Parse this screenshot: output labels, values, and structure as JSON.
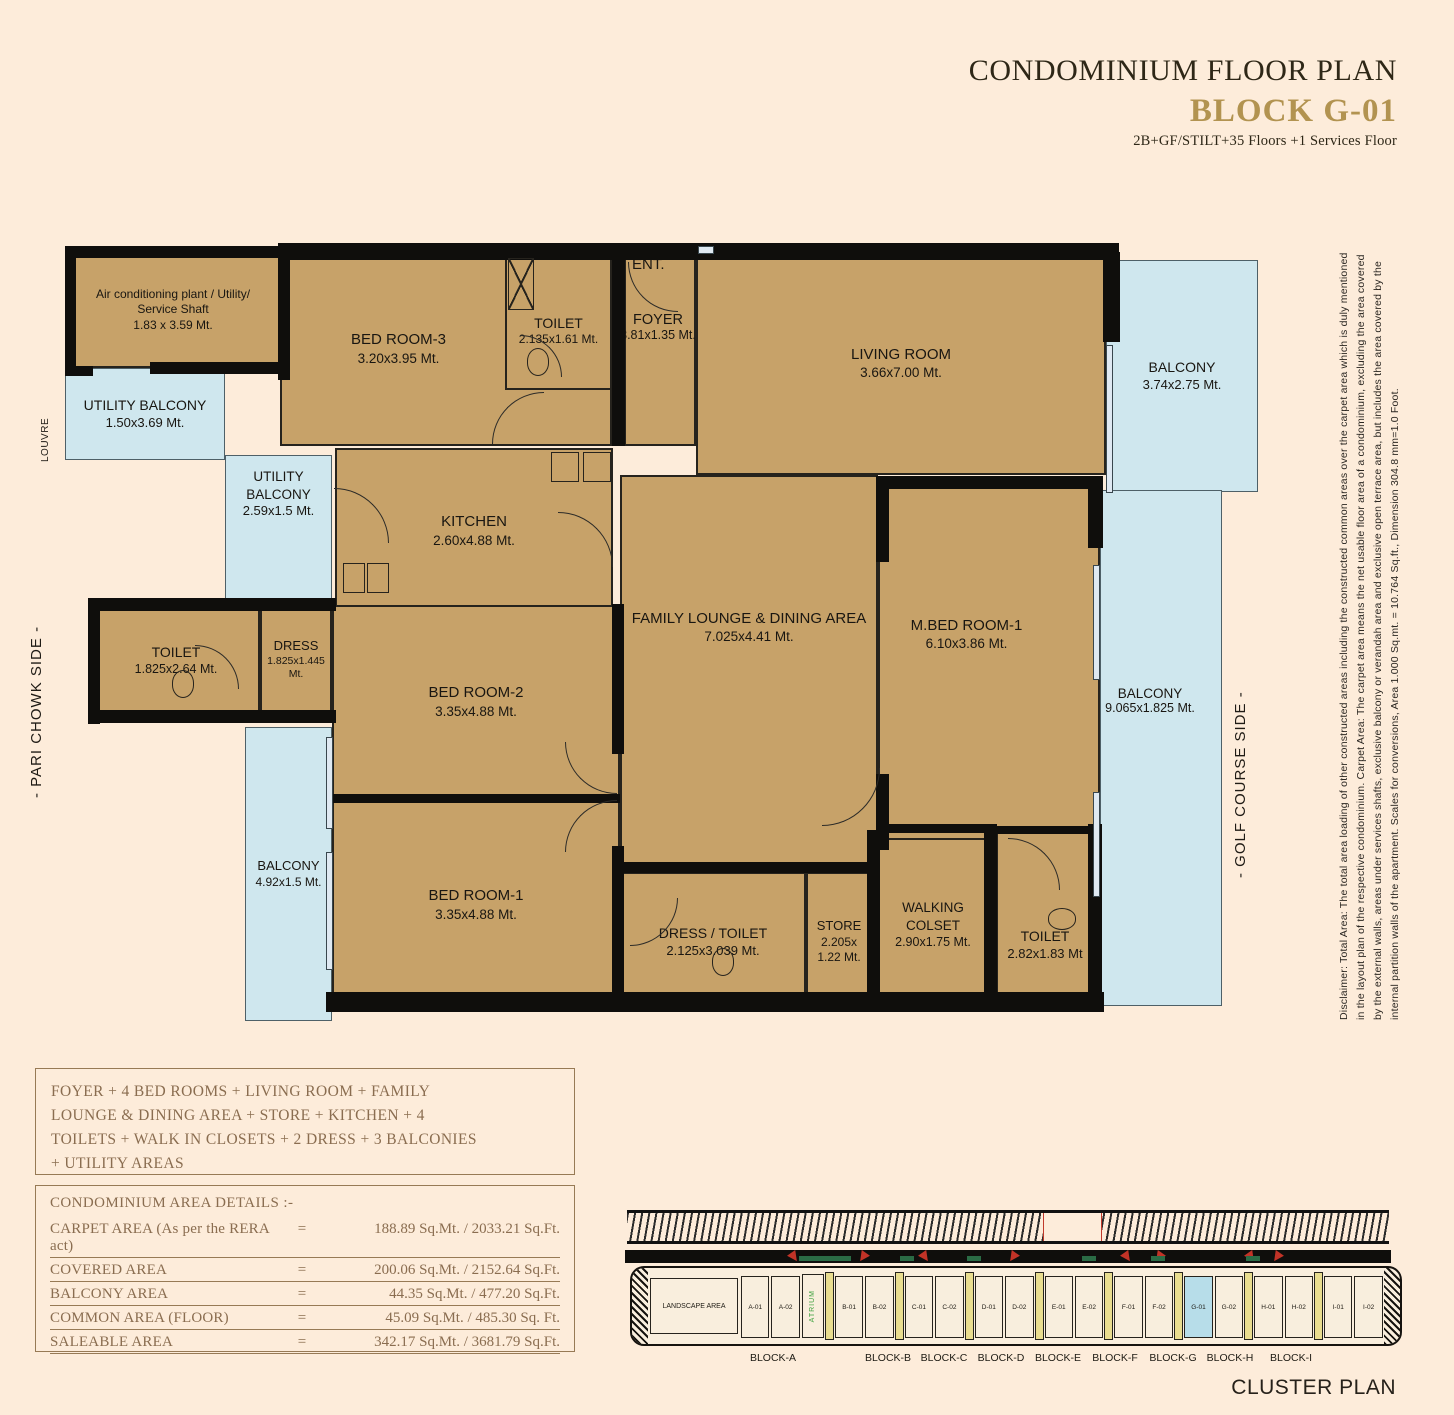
{
  "header": {
    "title": "CONDOMINIUM FLOOR PLAN",
    "block": "BLOCK G-01",
    "subtitle": "2B+GF/STILT+35 Floors +1 Services Floor"
  },
  "side_labels": {
    "left": "- PARI CHOWK SIDE -",
    "right": "- GOLF COURSE SIDE -",
    "louvre": "LOUVRE",
    "ent": "ENT."
  },
  "rooms": [
    {
      "name": "Air conditioning plant / Utility/ Service Shaft",
      "dims": "1.83 x 3.59 Mt."
    },
    {
      "name": "UTILITY BALCONY",
      "dims": "1.50x3.69 Mt."
    },
    {
      "name": "UTILITY BALCONY",
      "dims": "2.59x1.5 Mt."
    },
    {
      "name": "BED ROOM-3",
      "dims": "3.20x3.95 Mt."
    },
    {
      "name": "TOILET",
      "dims": "2.135x1.61 Mt."
    },
    {
      "name": "FOYER",
      "dims": "3.81x1.35 Mt."
    },
    {
      "name": "LIVING ROOM",
      "dims": "3.66x7.00 Mt."
    },
    {
      "name": "BALCONY",
      "dims": "3.74x2.75 Mt."
    },
    {
      "name": "KITCHEN",
      "dims": "2.60x4.88 Mt."
    },
    {
      "name": "FAMILY LOUNGE & DINING AREA",
      "dims": "7.025x4.41 Mt."
    },
    {
      "name": "M.BED ROOM-1",
      "dims": "6.10x3.86 Mt."
    },
    {
      "name": "BALCONY",
      "dims": "9.065x1.825 Mt."
    },
    {
      "name": "TOILET",
      "dims": "1.825x2.64 Mt."
    },
    {
      "name": "DRESS",
      "dims": "1.825x1.445 Mt."
    },
    {
      "name": "BED ROOM-2",
      "dims": "3.35x4.88 Mt."
    },
    {
      "name": "BALCONY",
      "dims": "4.92x1.5 Mt."
    },
    {
      "name": "BED ROOM-1",
      "dims": "3.35x4.88 Mt."
    },
    {
      "name": "DRESS / TOILET",
      "dims": "2.125x3.039 Mt."
    },
    {
      "name": "STORE",
      "dims": "2.205x 1.22 Mt."
    },
    {
      "name": "WALKING COLSET",
      "dims": "2.90x1.75 Mt."
    },
    {
      "name": "TOILET",
      "dims": "2.82x1.83 Mt"
    }
  ],
  "summary_lines": [
    "FOYER + 4 BED ROOMS + LIVING ROOM + FAMILY",
    "LOUNGE & DINING AREA + STORE + KITCHEN + 4",
    "TOILETS + WALK IN CLOSETS + 2 DRESS + 3 BALCONIES",
    "+ UTILITY AREAS"
  ],
  "area_details": {
    "title": "CONDOMINIUM AREA DETAILS :-",
    "eq": "=",
    "rows": [
      {
        "label": "CARPET AREA  (As per the RERA act)",
        "value": "188.89 Sq.Mt. / 2033.21 Sq.Ft."
      },
      {
        "label": "COVERED AREA",
        "value": "200.06 Sq.Mt. / 2152.64 Sq.Ft."
      },
      {
        "label": "BALCONY AREA",
        "value": "44.35 Sq.Mt. / 477.20 Sq.Ft."
      },
      {
        "label": "COMMON AREA (FLOOR)",
        "value": "45.09 Sq.Mt. / 485.30 Sq. Ft."
      },
      {
        "label": "SALEABLE AREA",
        "value": "342.17 Sq.Mt. / 3681.79 Sq.Ft."
      }
    ]
  },
  "disclaimer_lines": [
    "Disclaimer:  Total Area: The total area loading of other constructed areas including the constructed common areas over the carpet area which is duly mentioned",
    "in the layout plan of the respective condominium. Carpet Area: The carpet area means the net usable floor area of a condominium, excluding the area covered",
    "by the external walls, areas under services shafts, exclusive balcony or verandah area and exclusive open terrace area, but includes the area covered by the",
    "internal partition walls of the apartment. Scales for conversions, Area 1.000 Sq.mt. = 10.764 Sq.ft., Dimension 304.8 mm=1.0 Foot."
  ],
  "cluster": {
    "title": "CLUSTER PLAN",
    "landscape": "LANDSCAPE AREA",
    "atrium": "ATRIUM",
    "highlighted_unit": "G-01",
    "units": [
      "A-01",
      "A-02",
      "B-01",
      "B-02",
      "C-01",
      "C-02",
      "D-01",
      "D-02",
      "E-01",
      "E-02",
      "F-01",
      "F-02",
      "G-01",
      "G-02",
      "H-01",
      "H-02",
      "I-01",
      "I-02"
    ],
    "blocks": [
      "BLOCK-A",
      "BLOCK-B",
      "BLOCK-C",
      "BLOCK-D",
      "BLOCK-E",
      "BLOCK-F",
      "BLOCK-G",
      "BLOCK-H",
      "BLOCK-I"
    ]
  },
  "colors": {
    "background": "#fdecda",
    "room_fill": "#c7a269",
    "balcony_fill": "#cfe7ee",
    "wall": "#0f0e0c",
    "accent_gold": "#b29350",
    "box_text": "#8a6d50",
    "unit_highlight": "#b7dde9",
    "atrium_green": "#3da13d",
    "arrow_red": "#c23327",
    "dash_green": "#2a6b45"
  }
}
